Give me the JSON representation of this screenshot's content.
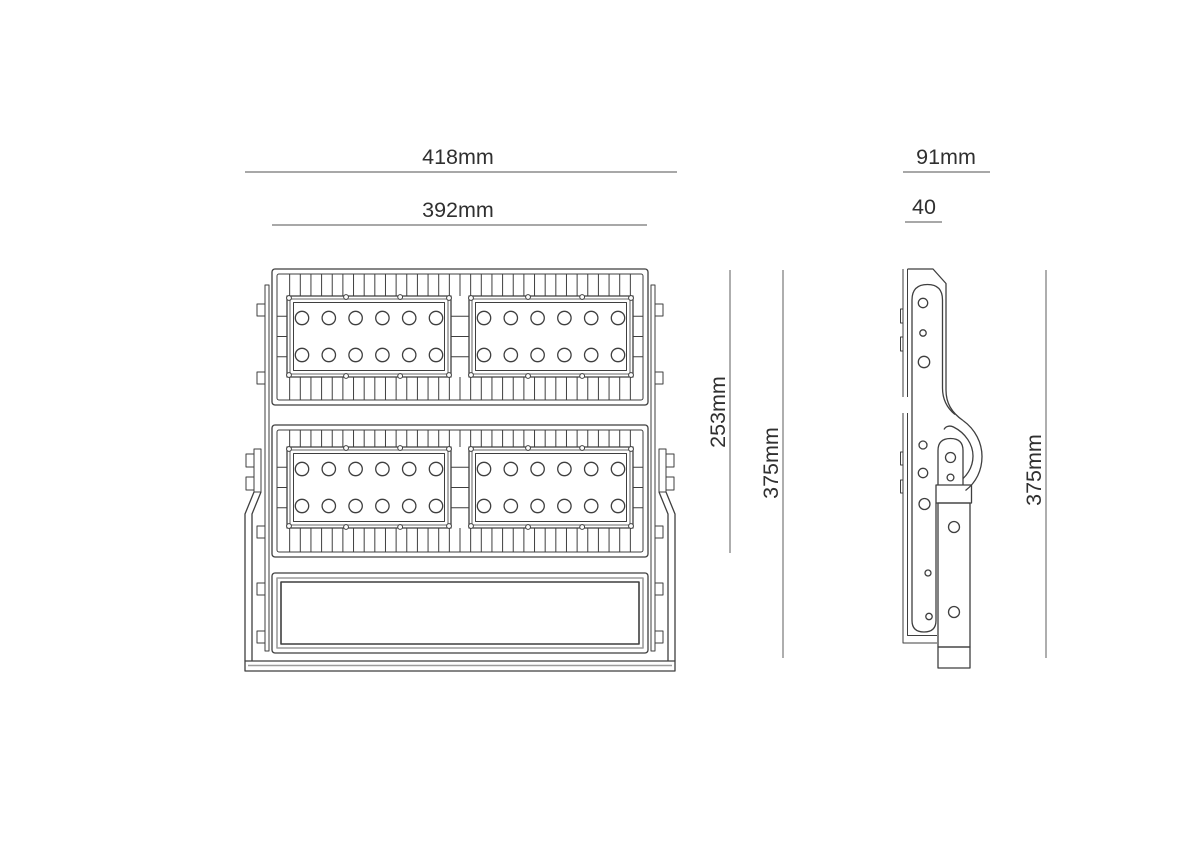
{
  "dimensions": {
    "front_overall_width": "418mm",
    "front_body_width": "392mm",
    "front_led_section_height": "253mm",
    "front_overall_height": "375mm",
    "side_overall_depth": "91mm",
    "side_body_depth": "40",
    "side_overall_height": "375mm"
  },
  "drawing": {
    "colors": {
      "line": "#3f3f3f",
      "light_line": "#9c9c9c",
      "dim_line": "#8b8b8b",
      "text": "#303030",
      "background": "#ffffff"
    },
    "front_view": {
      "body": {
        "x": 272,
        "w": 376
      },
      "sections": [
        {
          "y": 269,
          "h": 136,
          "panel_y": 296,
          "panel_h": 81
        },
        {
          "y": 425,
          "h": 132,
          "panel_y": 447,
          "panel_h": 81
        }
      ],
      "driver": {
        "y": 573,
        "h": 80
      },
      "panels_x": [
        287,
        469
      ],
      "panel_w": 164,
      "led": {
        "cols": 6,
        "rows": 2,
        "r": 6.7,
        "inset_x": 15,
        "row_offsets": [
          22,
          59
        ]
      },
      "fins": {
        "x1": 279,
        "x2": 641,
        "count": 34
      },
      "strips": {
        "left_x": 265,
        "right_x": 651,
        "w": 4,
        "y": 285,
        "h": 366
      },
      "tabs": {
        "ys": [
          304,
          372,
          526,
          583,
          631
        ],
        "w": 8,
        "h": 12
      }
    }
  }
}
